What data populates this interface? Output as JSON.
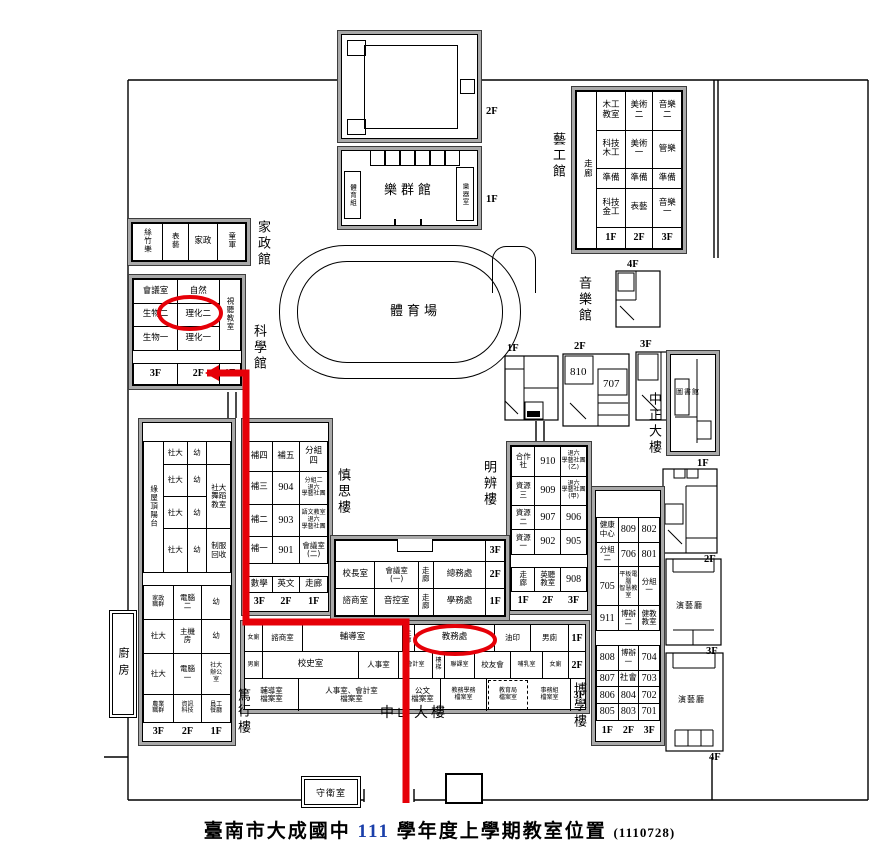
{
  "title": {
    "school": "臺南市大成國中",
    "year": "111",
    "rest": "學年度上學期教室位置",
    "note": "(1110728)"
  },
  "colors": {
    "highlight_red": "#e60008",
    "year_blue": "#1a3faa",
    "building_gray": "#a9a9a9"
  },
  "annotations": {
    "circled_rooms": [
      "理化二",
      "教務處"
    ],
    "route": "科學館2F → 校門"
  },
  "labels": {
    "field": "體育場",
    "lequn": "樂群館",
    "lequn_left": "體育組",
    "lequn_right": "樂器室",
    "lequn_2f": "2F",
    "lequn_1f": "1F",
    "yigong": "藝工館",
    "jiazheng": "家政館",
    "kexue": "科學館",
    "yinyue": "音樂館",
    "zhongzheng": "中正大樓",
    "tushuguan": "圖書館",
    "mingbian": "明辨樓",
    "shensi": "慎思樓",
    "boxue": "博學樓",
    "duxing": "篤行樓",
    "zhongshan": "中山大樓",
    "chufang": "廚房",
    "shouwei": "守衛室",
    "yanyiting": "演藝廳",
    "mf1": "1F",
    "mf2": "2F",
    "mf3": "3F",
    "mf4": "4F",
    "rf1": "1F",
    "rf2": "2F",
    "rf3": "3F",
    "rf4": "4F",
    "r810": "810",
    "r707": "707"
  },
  "tables": {
    "jiazheng": [
      [
        {
          "t": "絲竹樂",
          "cls": "v sm",
          "w": 30
        },
        {
          "t": "表藝",
          "cls": "v sm",
          "w": 26
        },
        {
          "t": "家政",
          "w": 30
        },
        {
          "t": "童軍",
          "cls": "v sm",
          "w": 28
        }
      ]
    ],
    "kexue": [
      [
        {
          "t": "會議室",
          "w": 38
        },
        {
          "t": "自然",
          "w": 36
        },
        {
          "t": "視聽教室",
          "cls": "v sm",
          "rs": 3,
          "w": 18
        }
      ],
      [
        {
          "t": "生物二"
        },
        {
          "t": "理化二"
        }
      ],
      [
        {
          "t": "生物一"
        },
        {
          "t": "理化一"
        }
      ],
      [
        {
          "t": "",
          "cs": 3,
          "cls": "blank",
          "h": 12
        }
      ],
      [
        {
          "t": "3F",
          "cls": "fl",
          "h": 20
        },
        {
          "t": "2F",
          "cls": "fl"
        },
        {
          "t": "1F",
          "cls": "fl"
        }
      ]
    ],
    "yigong": [
      [
        {
          "t": "走廊",
          "cls": "v",
          "rs": 5,
          "w": 20
        },
        {
          "t": "木工\n教室",
          "w": 29
        },
        {
          "t": "美術\n二",
          "w": 28
        },
        {
          "t": "音樂\n二",
          "w": 29
        }
      ],
      [
        {
          "t": "科技\n木工"
        },
        {
          "t": "美術\n一"
        },
        {
          "t": "管樂"
        }
      ],
      [
        {
          "t": "準備"
        },
        {
          "t": "準備"
        },
        {
          "t": "準備"
        }
      ],
      [
        {
          "t": "科技\n金工"
        },
        {
          "t": "表藝"
        },
        {
          "t": "音樂\n一"
        }
      ],
      [
        {
          "t": "1F",
          "cls": "fl",
          "h": 20
        },
        {
          "t": "2F",
          "cls": "fl"
        },
        {
          "t": "3F",
          "cls": "fl"
        }
      ]
    ],
    "shensi": [
      [
        {
          "t": "",
          "cs": 3,
          "cls": "blank",
          "h": 18
        }
      ],
      [
        {
          "t": "補四",
          "w": 26
        },
        {
          "t": "補五",
          "w": 28
        },
        {
          "t": "分組\n四",
          "w": 28
        }
      ],
      [
        {
          "t": "補三"
        },
        {
          "t": "904",
          "cls": "num"
        },
        {
          "t": "分組二\n退六\n學藝社團",
          "cls": "tiny"
        }
      ],
      [
        {
          "t": "補二"
        },
        {
          "t": "903",
          "cls": "num"
        },
        {
          "t": "語文教室\n退六\n學藝社團",
          "cls": "tiny"
        }
      ],
      [
        {
          "t": "補一"
        },
        {
          "t": "901",
          "cls": "num"
        },
        {
          "t": "會議室\n(二)",
          "cls": "sm"
        }
      ],
      [
        {
          "t": "",
          "cs": 3,
          "cls": "blank",
          "h": 12
        }
      ],
      [
        {
          "t": "數學"
        },
        {
          "t": "英文"
        },
        {
          "t": "走廊"
        }
      ],
      [
        {
          "t": "3F",
          "cls": "fl nb",
          "h": 18
        },
        {
          "t": "2F",
          "cls": "fl nb"
        },
        {
          "t": "1F",
          "cls": "fl nb"
        }
      ]
    ],
    "mingbian": [
      [
        {
          "t": "合作\n社",
          "cls": "sm",
          "w": 24
        },
        {
          "t": "910",
          "cls": "num",
          "w": 26
        },
        {
          "t": "退六\n學藝社團\n(乙)",
          "cls": "tiny",
          "w": 26
        }
      ],
      [
        {
          "t": "資源\n三",
          "cls": "sm"
        },
        {
          "t": "909",
          "cls": "num"
        },
        {
          "t": "退六\n學藝社團\n(甲)",
          "cls": "tiny"
        }
      ],
      [
        {
          "t": "資源\n二",
          "cls": "sm"
        },
        {
          "t": "907",
          "cls": "num"
        },
        {
          "t": "906",
          "cls": "num"
        }
      ],
      [
        {
          "t": "資源\n一",
          "cls": "sm"
        },
        {
          "t": "902",
          "cls": "num"
        },
        {
          "t": "905",
          "cls": "num"
        }
      ],
      [
        {
          "t": "",
          "cs": 3,
          "cls": "blank",
          "h": 12
        }
      ],
      [
        {
          "t": "走\n廊",
          "cls": "sm"
        },
        {
          "t": "英聽\n教室",
          "cls": "sm"
        },
        {
          "t": "908",
          "cls": "num"
        }
      ],
      [
        {
          "t": "1F",
          "cls": "fl nb",
          "h": 18
        },
        {
          "t": "2F",
          "cls": "fl nb"
        },
        {
          "t": "3F",
          "cls": "fl nb"
        }
      ]
    ],
    "boxue": [
      [
        {
          "t": "",
          "cs": 3,
          "cls": "blank",
          "h": 26
        }
      ],
      [
        {
          "t": "健康\n中心",
          "cls": "sm",
          "w": 22
        },
        {
          "t": "809",
          "cls": "num",
          "w": 21
        },
        {
          "t": "802",
          "cls": "num",
          "w": 21
        }
      ],
      [
        {
          "t": "分組\n二",
          "cls": "sm"
        },
        {
          "t": "706",
          "cls": "num"
        },
        {
          "t": "801",
          "cls": "num"
        }
      ],
      [
        {
          "t": "705",
          "cls": "num"
        },
        {
          "t": "平板電腦\n智慧教室",
          "cls": "tiny"
        },
        {
          "t": "分組\n一",
          "cls": "sm"
        }
      ],
      [
        {
          "t": "911",
          "cls": "num"
        },
        {
          "t": "博辦\n二",
          "cls": "sm"
        },
        {
          "t": "健教\n教室",
          "cls": "sm"
        }
      ],
      [
        {
          "t": "",
          "cs": 3,
          "cls": "blank",
          "h": 14
        }
      ],
      [
        {
          "t": "808",
          "cls": "num"
        },
        {
          "t": "博辦\n一",
          "cls": "sm"
        },
        {
          "t": "704",
          "cls": "num"
        }
      ],
      [
        {
          "t": "807",
          "cls": "num"
        },
        {
          "t": "社會"
        },
        {
          "t": "703",
          "cls": "num"
        }
      ],
      [
        {
          "t": "806",
          "cls": "num"
        },
        {
          "t": "804",
          "cls": "num"
        },
        {
          "t": "702",
          "cls": "num"
        }
      ],
      [
        {
          "t": "805",
          "cls": "num"
        },
        {
          "t": "803",
          "cls": "num"
        },
        {
          "t": "701",
          "cls": "num"
        }
      ],
      [
        {
          "t": "1F",
          "cls": "fl nb",
          "h": 20
        },
        {
          "t": "2F",
          "cls": "fl nb"
        },
        {
          "t": "3F",
          "cls": "fl nb"
        }
      ]
    ],
    "duxing_top": [
      [
        {
          "t": "",
          "cs": 4,
          "cls": "blank",
          "h": 18
        }
      ],
      [
        {
          "t": "綠屋頂陽台",
          "cls": "v sm",
          "rs": 4,
          "w": 20
        },
        {
          "t": "社大",
          "cls": "sm",
          "w": 24
        },
        {
          "t": "幼",
          "cls": "sm",
          "w": 20
        },
        {
          "t": "",
          "w": 24
        }
      ],
      [
        {
          "t": "社大",
          "cls": "sm"
        },
        {
          "t": "幼",
          "cls": "sm"
        },
        {
          "t": "社大\n舞蹈\n教室",
          "cls": "sm",
          "rs": 2
        }
      ],
      [
        {
          "t": "社大",
          "cls": "sm"
        },
        {
          "t": "幼",
          "cls": "sm"
        }
      ],
      [
        {
          "t": "社大",
          "cls": "sm"
        },
        {
          "t": "幼",
          "cls": "sm"
        },
        {
          "t": "制服\n回收",
          "cls": "sm"
        }
      ]
    ],
    "duxing_bottom": [
      [
        {
          "t": "家政\n職群",
          "cls": "tiny",
          "w": 30
        },
        {
          "t": "電腦\n二",
          "cls": "sm",
          "w": 29
        },
        {
          "t": "幼",
          "cls": "sm",
          "w": 29
        }
      ],
      [
        {
          "t": "社大",
          "cls": "sm"
        },
        {
          "t": "主機\n房",
          "cls": "sm"
        },
        {
          "t": "幼",
          "cls": "sm"
        }
      ],
      [
        {
          "t": "社大",
          "cls": "sm"
        },
        {
          "t": "電腦\n一",
          "cls": "sm"
        },
        {
          "t": "社大\n辦公\n室",
          "cls": "tiny"
        }
      ],
      [
        {
          "t": "農業\n職群",
          "cls": "tiny"
        },
        {
          "t": "資訊\n科技",
          "cls": "tiny"
        },
        {
          "t": "員工\n餐廳",
          "cls": "tiny"
        }
      ],
      [
        {
          "t": "3F",
          "cls": "fl nb",
          "h": 18
        },
        {
          "t": "2F",
          "cls": "fl nb"
        },
        {
          "t": "1F",
          "cls": "fl nb"
        }
      ]
    ],
    "admin": [
      [
        {
          "t": "",
          "cs": 4,
          "cls": "",
          "h": 20
        },
        {
          "t": "3F",
          "cls": "fl",
          "w": 18
        }
      ],
      [
        {
          "t": "校長室",
          "w": 40
        },
        {
          "t": "會議室\n(一)",
          "cls": "sm",
          "w": 44
        },
        {
          "t": "走\n廊",
          "cls": "sm",
          "w": 14
        },
        {
          "t": "總務處",
          "w": 54
        },
        {
          "t": "2F",
          "cls": "fl"
        }
      ],
      [
        {
          "t": "諮商室"
        },
        {
          "t": "音控室"
        },
        {
          "t": "走\n廊",
          "cls": "sm"
        },
        {
          "t": "學務處"
        },
        {
          "t": "1F",
          "cls": "fl"
        }
      ]
    ]
  },
  "zhongshan": {
    "rows": [
      {
        "h": 26,
        "cells": [
          {
            "t": "女廁",
            "w": 18,
            "cls": "tiny"
          },
          {
            "t": "諮商室",
            "w": 40,
            "cls": "sm"
          },
          {
            "t": "輔導室",
            "w": 100
          },
          {
            "t": "走\n廊",
            "w": 12,
            "cls": "tiny"
          },
          {
            "t": "教務處",
            "w": 80
          },
          {
            "t": "油印",
            "w": 36,
            "cls": "sm"
          },
          {
            "t": "男廁",
            "w": 38,
            "cls": "sm"
          },
          {
            "t": "1F",
            "w": 16,
            "cls": "fl"
          }
        ]
      },
      {
        "h": 26,
        "cells": [
          {
            "t": "男廁",
            "w": 18,
            "cls": "tiny"
          },
          {
            "t": "校史室",
            "w": 96
          },
          {
            "t": "人事室",
            "w": 40,
            "cls": "sm"
          },
          {
            "t": "會計室",
            "w": 34,
            "cls": "tiny"
          },
          {
            "t": "樓\n梯",
            "w": 12,
            "cls": "tiny"
          },
          {
            "t": "聯課室",
            "w": 30,
            "cls": "tiny"
          },
          {
            "t": "校友會",
            "w": 36,
            "cls": "sm"
          },
          {
            "t": "哺乳室",
            "w": 32,
            "cls": "tiny"
          },
          {
            "t": "女廁",
            "w": 26,
            "cls": "tiny"
          },
          {
            "t": "2F",
            "w": 16,
            "cls": "fl"
          }
        ]
      },
      {
        "h": 32,
        "cells": [
          {
            "t": "輔導室\n檔案室",
            "w": 54,
            "cls": "sm"
          },
          {
            "t": "人事室、會計室\n檔案室",
            "w": 106,
            "cls": "sm"
          },
          {
            "t": "公文\n檔案室",
            "w": 36,
            "cls": "sm"
          },
          {
            "t": "教務學務\n檔案室",
            "w": 46,
            "cls": "tiny"
          },
          {
            "t": "教育局\n檔案室",
            "w": 40,
            "cls": "tiny dashed"
          },
          {
            "t": "事務組\n檔案室",
            "w": 42,
            "cls": "tiny"
          },
          {
            "t": "3F",
            "w": 16,
            "cls": "fl"
          }
        ]
      }
    ]
  }
}
